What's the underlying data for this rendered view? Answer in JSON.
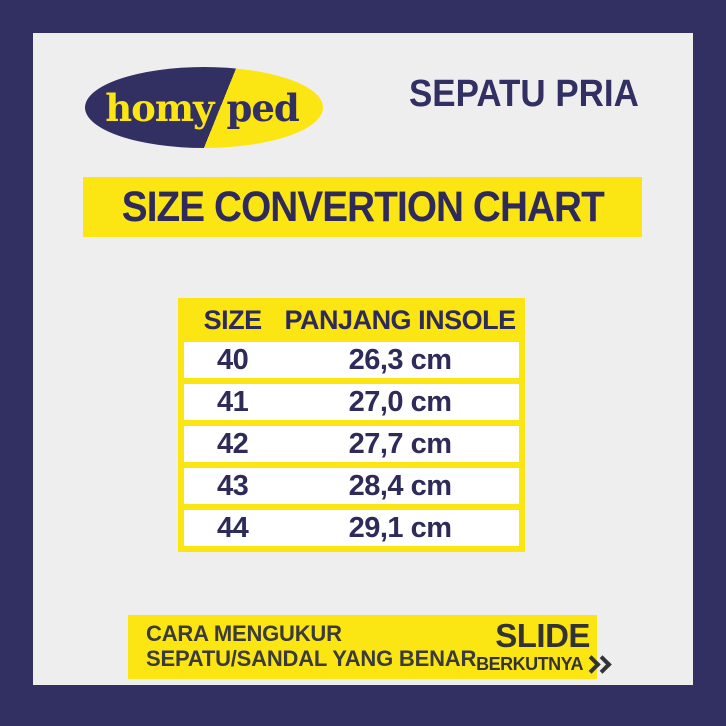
{
  "brand": {
    "name_left": "homy",
    "name_right": "ped"
  },
  "header": {
    "category": "SEPATU PRIA"
  },
  "title_banner": {
    "title": "SIZE CONVERTION CHART"
  },
  "chart_data": {
    "type": "table",
    "title": "SIZE CONVERTION CHART",
    "columns": [
      "SIZE",
      "PANJANG INSOLE"
    ],
    "rows": [
      {
        "size": "40",
        "insole": "26,3 cm"
      },
      {
        "size": "41",
        "insole": "27,0 cm"
      },
      {
        "size": "42",
        "insole": "27,7 cm"
      },
      {
        "size": "43",
        "insole": "28,4 cm"
      },
      {
        "size": "44",
        "insole": "29,1 cm"
      }
    ],
    "sizes_numeric": [
      40,
      41,
      42,
      43,
      44
    ],
    "insole_cm_numeric": [
      26.3,
      27.0,
      27.7,
      28.4,
      29.1
    ]
  },
  "footer": {
    "note_line1": "CARA MENGUKUR",
    "note_line2": "SEPATU/SANDAL YANG BENAR",
    "slide_label": "SLIDE",
    "next_label": "BERKUTNYA",
    "next_icon": "chevron-double-right-icon"
  },
  "colors": {
    "frame_navy": "#322f63",
    "accent_yellow": "#fbe513",
    "inner_background": "#efeeef",
    "table_text_navy": "#2e2a5a",
    "footer_text_dark": "#3b3b3b"
  }
}
